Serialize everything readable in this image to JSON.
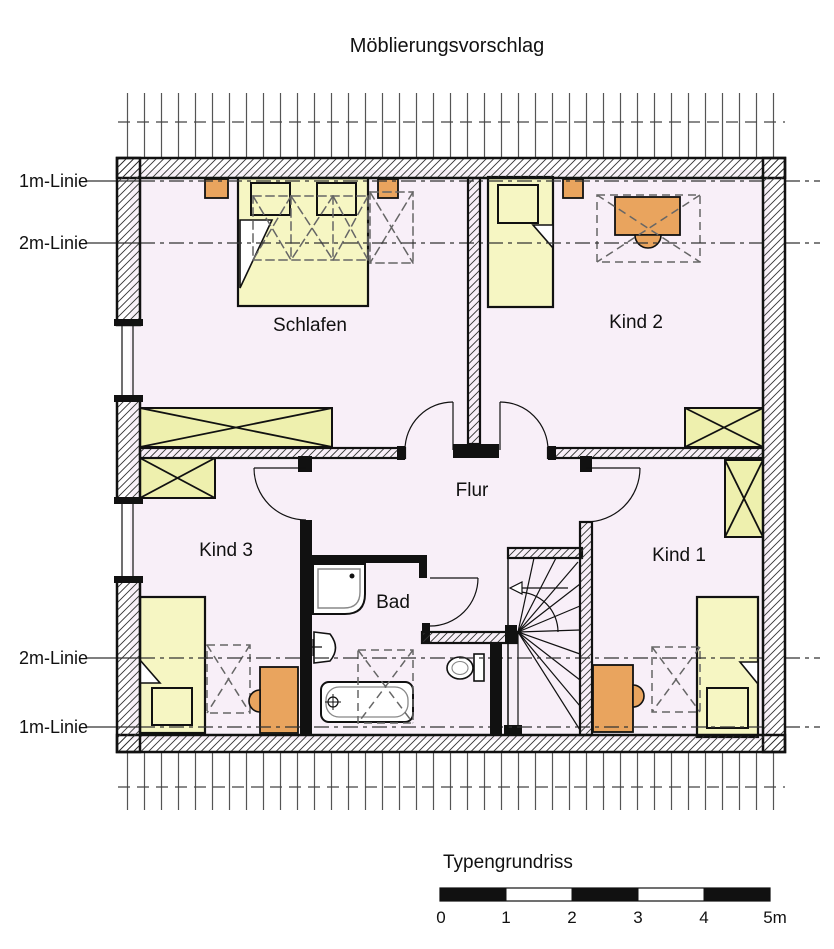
{
  "title": "Möblierungsvorschlag",
  "rooms": {
    "schlafen": "Schlafen",
    "kind2": "Kind 2",
    "kind3": "Kind 3",
    "kind1": "Kind 1",
    "flur": "Flur",
    "bad": "Bad"
  },
  "guides": {
    "top_1m": "1m-Linie",
    "top_2m": "2m-Linie",
    "bottom_2m": "2m-Linie",
    "bottom_1m": "1m-Linie"
  },
  "footer": {
    "caption": "Typengrundriss",
    "scale_ticks": [
      "0",
      "1",
      "2",
      "3",
      "4",
      "5m"
    ]
  },
  "colors": {
    "floor": "#f8eff8",
    "bed_yellow": "#f6f6c3",
    "wardrobe_yellow": "#eef0ae",
    "furniture_orange": "#e9a45e",
    "line_black": "#111111",
    "hatch_gray": "#333333"
  }
}
